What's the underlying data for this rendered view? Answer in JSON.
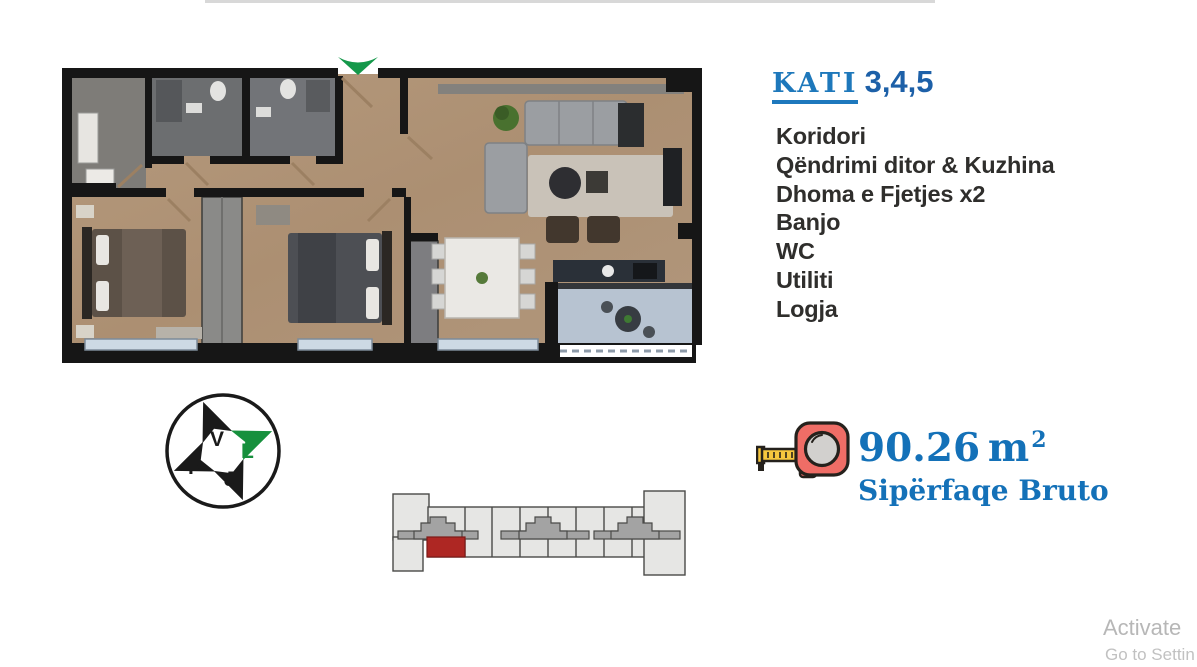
{
  "page": {
    "background": "#ffffff",
    "top_rule_color": "#d8d8d8"
  },
  "title": {
    "label": "KATI",
    "floors": "3,4,5",
    "label_color": "#1e78bb",
    "floors_color": "#1d60a8",
    "underline_color": "#1d78bd"
  },
  "room_list": {
    "text_color": "#2f2e2c",
    "items": [
      "Koridori",
      "Qëndrimi ditor & Kuzhina",
      "Dhoma e Fjetjes x2",
      "Banjo",
      "WC",
      "Utiliti",
      "Logja"
    ]
  },
  "area": {
    "icon": "tape-measure-icon",
    "value": "90.26",
    "unit": "m",
    "exponent": "2",
    "caption": "Sipërfaqe Bruto",
    "color": "#1471b8"
  },
  "compass": {
    "north_label": "V",
    "east_label": "L",
    "south_label": "J",
    "west_label": "P",
    "east_accent_color": "#17903d",
    "arrow_color": "#1a1a1a"
  },
  "floorplan": {
    "entrance_marker_color": "#14984a",
    "wall_color": "#161616",
    "wood_floor_color": "#b09478",
    "bath_tile_color": "#6e7072",
    "balcony_floor_color": "#b7c3d1"
  },
  "site_plan": {
    "building_fill": "#e6e6e4",
    "core_fill": "#a3a3a3",
    "unit_highlight_color": "#ae2723"
  },
  "watermark": {
    "line1": "Activate",
    "line2": "Go to Settin",
    "color": "#b7b7b7"
  }
}
